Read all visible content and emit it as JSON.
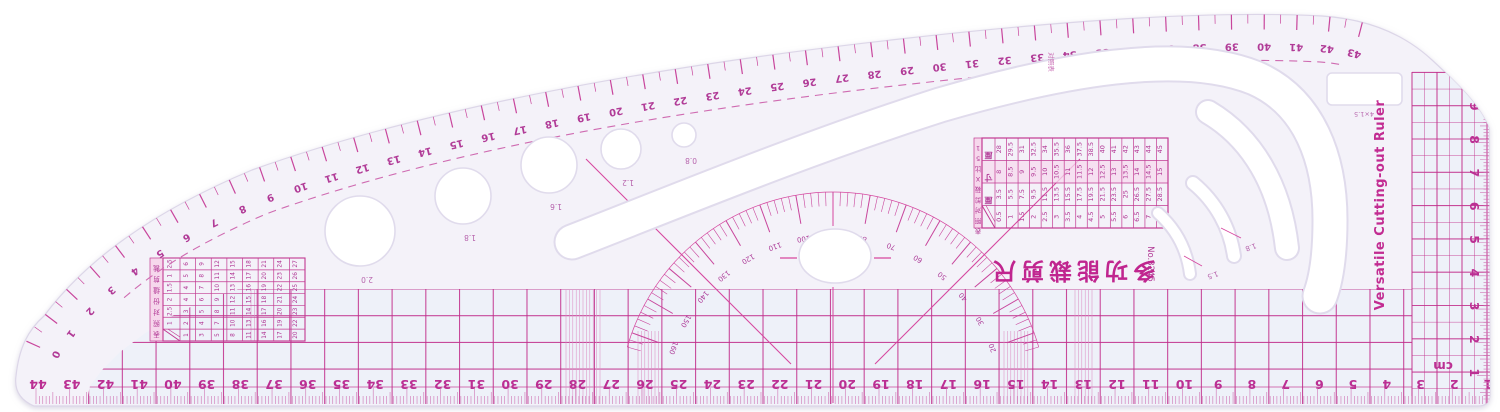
{
  "product": {
    "name_en": "Versatile Cutting-out Ruler",
    "name_cn": "多功能裁剪尺",
    "model_no": "No.3245",
    "unit": "cm",
    "corner_note": "对照表"
  },
  "colors": {
    "body": "#f4f2f9",
    "cell": "#edf1f8",
    "line_bold": "#c12d8b",
    "line": "#d6479f",
    "line_soft": "#e093c6",
    "text_magenta": "#b03694",
    "cut_stroke": "#e0dbec"
  },
  "scales": {
    "top_curve_numbers": [
      0,
      1,
      2,
      3,
      4,
      5,
      6,
      7,
      8,
      9,
      10,
      11,
      12,
      13,
      14,
      15,
      16,
      17,
      18,
      19,
      20,
      21,
      22,
      23,
      24,
      25,
      26,
      27,
      28,
      29,
      30,
      31,
      32,
      33,
      34,
      35,
      36,
      37,
      38,
      39,
      40,
      41,
      42,
      43
    ],
    "bottom_numbers": [
      44,
      43,
      42,
      41,
      40,
      39,
      38,
      37,
      36,
      35,
      34,
      33,
      32,
      31,
      30,
      29,
      28,
      27,
      26,
      25,
      24,
      23,
      22,
      21,
      20,
      19,
      18,
      17,
      16,
      15,
      14,
      13,
      12,
      11,
      10,
      9,
      8,
      7,
      6,
      5,
      4,
      3,
      2,
      1
    ],
    "right_numbers": [
      10,
      9,
      8,
      7,
      6,
      5,
      4,
      3,
      2,
      1
    ],
    "protractor_degrees": [
      20,
      30,
      40,
      50,
      60,
      70,
      80,
      90,
      100,
      110,
      120,
      130,
      140,
      150,
      160
    ],
    "bottom_unit_label": "cm",
    "right_unit_label": "cm"
  },
  "circle_templates": {
    "labels": [
      "2.0",
      "1.8",
      "1.6",
      "1.2",
      "0.8"
    ]
  },
  "slots": {
    "buttonhole_label": "4×1.5",
    "arc_labels": [
      "1.8",
      "1.5"
    ]
  },
  "tables": {
    "size_chart": {
      "title": "15比X裁剪对照表",
      "row_headers": [
        "厘",
        "寸",
        "厘"
      ],
      "rows": [
        [
          "28",
          "29.5",
          "31",
          "32.5",
          "34",
          "35.5",
          "36",
          "37.5",
          "38.5",
          "40",
          "41",
          "42",
          "43",
          "44",
          "45"
        ],
        [
          "8",
          "8.5",
          "9",
          "9.5",
          "10",
          "10.5",
          "11",
          "11.5",
          "12",
          "12.5",
          "13",
          "13.5",
          "14",
          "14.5",
          "15"
        ],
        [
          "3.5",
          "5.5",
          "7.5",
          "9.5",
          "11.5",
          "13.5",
          "15.5",
          "17.5",
          "19.5",
          "21.5",
          "23.5",
          "25",
          "26.5",
          "27.5",
          "28.5"
        ],
        [
          "0.5",
          "1",
          "1.5",
          "2",
          "2.5",
          "3",
          "3.5",
          "4",
          "4.5",
          "5",
          "5.5",
          "6",
          "6.5",
          "7",
          "7.5"
        ]
      ]
    },
    "quick_chart": {
      "title": "裁剪缝份对照表",
      "rows": [
        [
          "2.5",
          "6",
          "9",
          "12",
          "15",
          "18",
          "21",
          "24",
          "27"
        ],
        [
          "1",
          "5",
          "8",
          "11",
          "14",
          "17",
          "20",
          "23",
          "26"
        ],
        [
          "1.5",
          "4",
          "7",
          "10",
          "13",
          "16",
          "19",
          "22",
          "25"
        ],
        [
          "2",
          "4",
          "6",
          "9",
          "12",
          "15",
          "18",
          "21",
          "24"
        ],
        [
          "2.5",
          "3",
          "5",
          "8",
          "11",
          "14",
          "17",
          "20",
          "23"
        ],
        [
          "1",
          "2",
          "4",
          "7",
          "10",
          "13",
          "16",
          "19",
          "22"
        ],
        [
          "",
          "1",
          "3",
          "5",
          "8",
          "11",
          "14",
          "17",
          "20"
        ]
      ]
    }
  }
}
